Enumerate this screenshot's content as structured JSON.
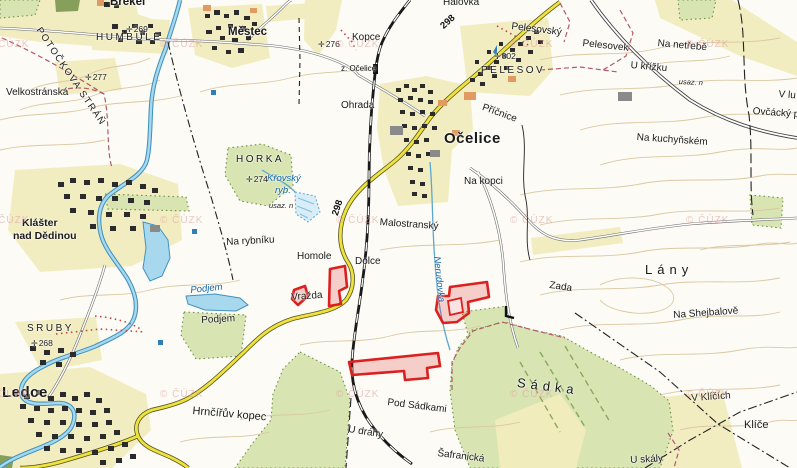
{
  "map": {
    "provider_watermark": "© ČÚZK",
    "colors": {
      "paper": "#fcfbf5",
      "field_yellow": "#f2edc0",
      "forest_green": "#d8e5b2",
      "water_fill": "#a8d8ee",
      "water_line": "#3f93bf",
      "contour": "#dbc8a2",
      "road_yellow": "#efe23e",
      "boundary_maroon": "#b05a6a",
      "highlight_red": "#dc2020",
      "watermark_pink": "#dc9c9c"
    },
    "labels": [
      {
        "text": "Brekel",
        "x": 110,
        "y": -3,
        "cls": "town-md",
        "rot": 0
      },
      {
        "text": "HUMBULE",
        "x": 96,
        "y": 33,
        "cls": "caps",
        "rot": 0
      },
      {
        "text": "Městec",
        "x": 228,
        "y": 27,
        "cls": "town-md",
        "rot": 0
      },
      {
        "text": "POTOČKOVA STRÁŇ",
        "x": 42,
        "y": 26,
        "cls": "caps-sp",
        "rot": 56
      },
      {
        "text": "Velkostránská",
        "x": 6,
        "y": 88,
        "cls": "field",
        "rot": 0
      },
      {
        "text": "Kopce",
        "x": 352,
        "y": 33,
        "cls": "field",
        "rot": 0
      },
      {
        "text": "Halovka",
        "x": 443,
        "y": -2,
        "cls": "field",
        "rot": 0
      },
      {
        "text": "Pelesovský",
        "x": 512,
        "y": 22,
        "cls": "field",
        "rot": 7
      },
      {
        "text": "Pelesovek",
        "x": 583,
        "y": 39,
        "cls": "field",
        "rot": 6
      },
      {
        "text": "Na netřebě",
        "x": 658,
        "y": 39,
        "cls": "field",
        "rot": 5
      },
      {
        "text": "U křížku",
        "x": 631,
        "y": 61,
        "cls": "field",
        "rot": 5
      },
      {
        "text": "usaz. n",
        "x": 679,
        "y": 78,
        "cls": "small-it",
        "rot": 3
      },
      {
        "text": "V lu",
        "x": 779,
        "y": 90,
        "cls": "field",
        "rot": 5
      },
      {
        "text": "Ovčácký p",
        "x": 753,
        "y": 107,
        "cls": "field",
        "rot": 4
      },
      {
        "text": "Na kuchyňském",
        "x": 637,
        "y": 133,
        "cls": "field",
        "rot": 4
      },
      {
        "text": "PELESOV",
        "x": 481,
        "y": 66,
        "cls": "caps",
        "rot": 0
      },
      {
        "text": "Očelice",
        "x": 444,
        "y": 131,
        "cls": "town-xl",
        "rot": 0
      },
      {
        "text": "Příčnice",
        "x": 484,
        "y": 103,
        "cls": "field",
        "rot": 20
      },
      {
        "text": "Ohrada",
        "x": 341,
        "y": 101,
        "cls": "field",
        "rot": 0
      },
      {
        "text": "z. Očelice",
        "x": 341,
        "y": 65,
        "cls": "small",
        "rot": 0
      },
      {
        "text": "Na kopci",
        "x": 464,
        "y": 177,
        "cls": "field",
        "rot": 0
      },
      {
        "text": "HORKA",
        "x": 236,
        "y": 155,
        "cls": "caps",
        "rot": 0
      },
      {
        "text": "Křovský",
        "x": 267,
        "y": 174,
        "cls": "water-it",
        "rot": 0
      },
      {
        "text": "ryb.",
        "x": 275,
        "y": 186,
        "cls": "water-it",
        "rot": 0
      },
      {
        "text": "usaz. n",
        "x": 269,
        "y": 202,
        "cls": "small-it",
        "rot": 0
      },
      {
        "text": "Klášter",
        "x": 22,
        "y": 218,
        "cls": "town-lg",
        "rot": 0
      },
      {
        "text": "nad Dědinou",
        "x": 13,
        "y": 231,
        "cls": "town-lg",
        "rot": 0
      },
      {
        "text": "Na rybníku",
        "x": 226,
        "y": 238,
        "cls": "field",
        "rot": -3
      },
      {
        "text": "Homole",
        "x": 297,
        "y": 252,
        "cls": "field",
        "rot": 0
      },
      {
        "text": "Malostranský",
        "x": 380,
        "y": 218,
        "cls": "field",
        "rot": 4
      },
      {
        "text": "Dolce",
        "x": 355,
        "y": 257,
        "cls": "field",
        "rot": 0
      },
      {
        "text": "Nerudovka",
        "x": 441,
        "y": 256,
        "cls": "water-it",
        "rot": 84
      },
      {
        "text": "Lány",
        "x": 645,
        "y": 263,
        "cls": "field-xl",
        "rot": 0
      },
      {
        "text": "Zada",
        "x": 550,
        "y": 281,
        "cls": "field",
        "rot": 8
      },
      {
        "text": "Vražda",
        "x": 291,
        "y": 293,
        "cls": "field",
        "rot": -4
      },
      {
        "text": "Podjem",
        "x": 190,
        "y": 286,
        "cls": "water-it",
        "rot": -6
      },
      {
        "text": "Podjem",
        "x": 201,
        "y": 316,
        "cls": "field",
        "rot": -3
      },
      {
        "text": "Na Shejbalově",
        "x": 673,
        "y": 311,
        "cls": "field",
        "rot": -4
      },
      {
        "text": "SRUBY",
        "x": 27,
        "y": 324,
        "cls": "caps",
        "rot": 0
      },
      {
        "text": "Ledce",
        "x": 2,
        "y": 385,
        "cls": "town-xl",
        "rot": 0
      },
      {
        "text": "Hrnčířův kopec",
        "x": 193,
        "y": 406,
        "cls": "field-md",
        "rot": 5
      },
      {
        "text": "Pod Sádkami",
        "x": 388,
        "y": 398,
        "cls": "field",
        "rot": 7
      },
      {
        "text": "U dráhy",
        "x": 349,
        "y": 425,
        "cls": "field",
        "rot": 9
      },
      {
        "text": "Šafranická",
        "x": 438,
        "y": 449,
        "cls": "field",
        "rot": 7
      },
      {
        "text": "Sádka",
        "x": 518,
        "y": 376,
        "cls": "field-xl",
        "rot": 7
      },
      {
        "text": "V Klíčích",
        "x": 691,
        "y": 394,
        "cls": "field",
        "rot": -4
      },
      {
        "text": "Klíče",
        "x": 744,
        "y": 420,
        "cls": "field-md",
        "rot": 0
      },
      {
        "text": "U skály",
        "x": 630,
        "y": 456,
        "cls": "field",
        "rot": -3
      }
    ],
    "elevations": [
      {
        "value": "269",
        "x": 126,
        "y": 25
      },
      {
        "value": "277",
        "x": 85,
        "y": 73
      },
      {
        "value": "276",
        "x": 318,
        "y": 40
      },
      {
        "value": "302",
        "x": 494,
        "y": 52
      },
      {
        "value": "274",
        "x": 246,
        "y": 175
      },
      {
        "value": "268",
        "x": 31,
        "y": 339
      }
    ],
    "road_numbers": [
      {
        "value": "298",
        "x": 439,
        "y": 24,
        "rot": -42
      },
      {
        "value": "298",
        "x": 331,
        "y": 214,
        "rot": -72
      }
    ],
    "watermark_positions": [
      {
        "x": -14,
        "y": 40
      },
      {
        "x": 160,
        "y": 40
      },
      {
        "x": 336,
        "y": 40
      },
      {
        "x": 510,
        "y": 40
      },
      {
        "x": 686,
        "y": 40
      },
      {
        "x": -14,
        "y": 216
      },
      {
        "x": 160,
        "y": 216
      },
      {
        "x": 336,
        "y": 216
      },
      {
        "x": 510,
        "y": 216
      },
      {
        "x": 686,
        "y": 216
      },
      {
        "x": -14,
        "y": 390
      },
      {
        "x": 160,
        "y": 390
      },
      {
        "x": 336,
        "y": 390
      },
      {
        "x": 510,
        "y": 390
      },
      {
        "x": 686,
        "y": 390
      }
    ],
    "highlight_parcels": [
      {
        "id": "parcel-vrazda-small",
        "points": [
          [
            294,
            290
          ],
          [
            305,
            286
          ],
          [
            308,
            296
          ],
          [
            298,
            305
          ],
          [
            292,
            299
          ]
        ]
      },
      {
        "id": "parcel-vrazda-tall",
        "points": [
          [
            330,
            269
          ],
          [
            345,
            266
          ],
          [
            347,
            287
          ],
          [
            339,
            291
          ],
          [
            341,
            304
          ],
          [
            329,
            306
          ]
        ]
      },
      {
        "id": "parcel-nerudovka",
        "points": [
          [
            450,
            287
          ],
          [
            487,
            282
          ],
          [
            489,
            297
          ],
          [
            468,
            302
          ],
          [
            469,
            313
          ],
          [
            457,
            322
          ],
          [
            443,
            323
          ],
          [
            436,
            310
          ],
          [
            438,
            296
          ],
          [
            449,
            296
          ]
        ],
        "inner": [
          [
            448,
            301
          ],
          [
            461,
            298
          ],
          [
            463,
            312
          ],
          [
            450,
            315
          ]
        ]
      },
      {
        "id": "parcel-pod-sadkami",
        "points": [
          [
            349,
            362
          ],
          [
            438,
            353
          ],
          [
            440,
            366
          ],
          [
            427,
            368
          ],
          [
            428,
            378
          ],
          [
            405,
            380
          ],
          [
            404,
            371
          ],
          [
            352,
            375
          ]
        ]
      }
    ]
  }
}
